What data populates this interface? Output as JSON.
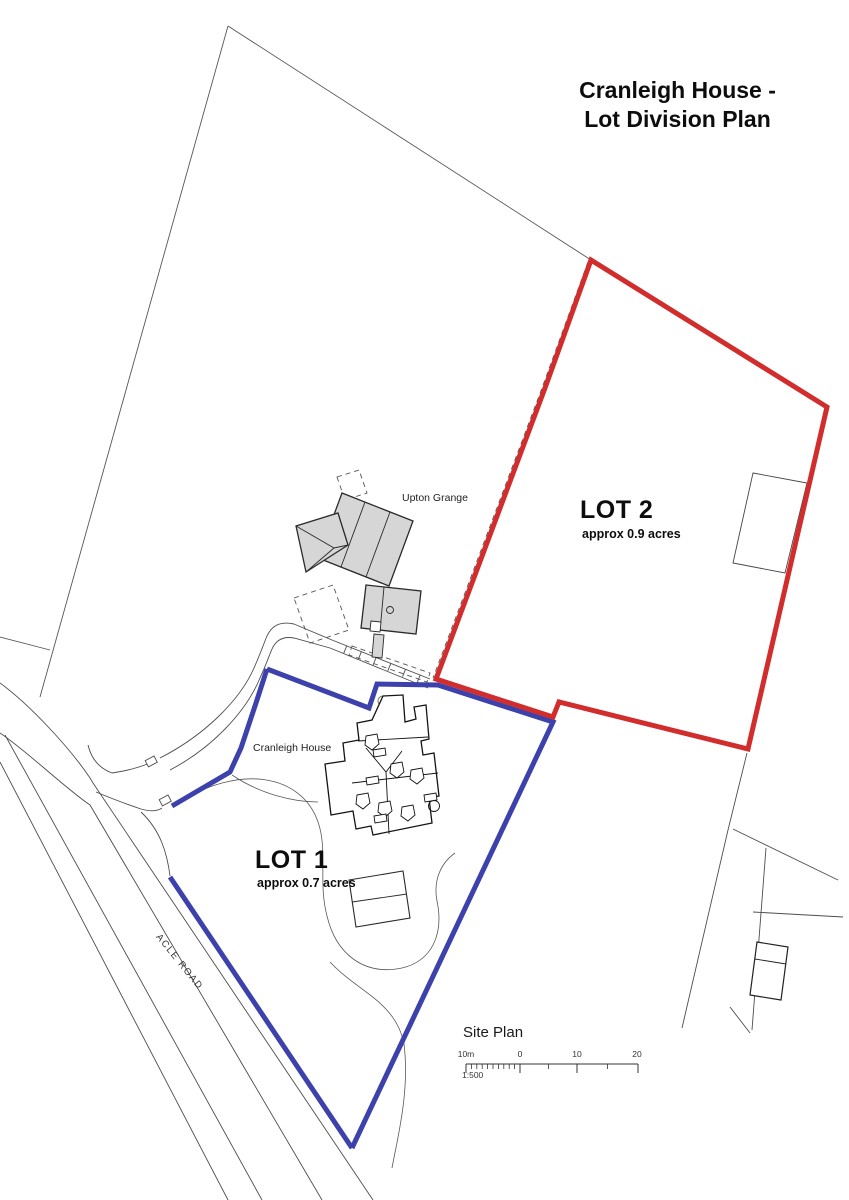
{
  "title": {
    "line1": "Cranleigh House -",
    "line2": "Lot Division Plan"
  },
  "lot1": {
    "name": "LOT 1",
    "area": "approx 0.7 acres",
    "boundary_color": "#3c41ab"
  },
  "lot2": {
    "name": "LOT 2",
    "area": "approx 0.9 acres",
    "boundary_color": "#d22d2d"
  },
  "labels": {
    "upton_grange": "Upton Grange",
    "cranleigh_house": "Cranleigh House",
    "acle_road": "ACLE ROAD"
  },
  "scale": {
    "title": "Site Plan",
    "ratio": "1:500",
    "ticks": [
      "10m",
      "0",
      "10",
      "20"
    ]
  },
  "colors": {
    "lot1_boundary": "#3c41ab",
    "lot2_boundary": "#d22d2d",
    "building_fill": "#d6d6d6",
    "thin_line": "#4d4d4d"
  }
}
